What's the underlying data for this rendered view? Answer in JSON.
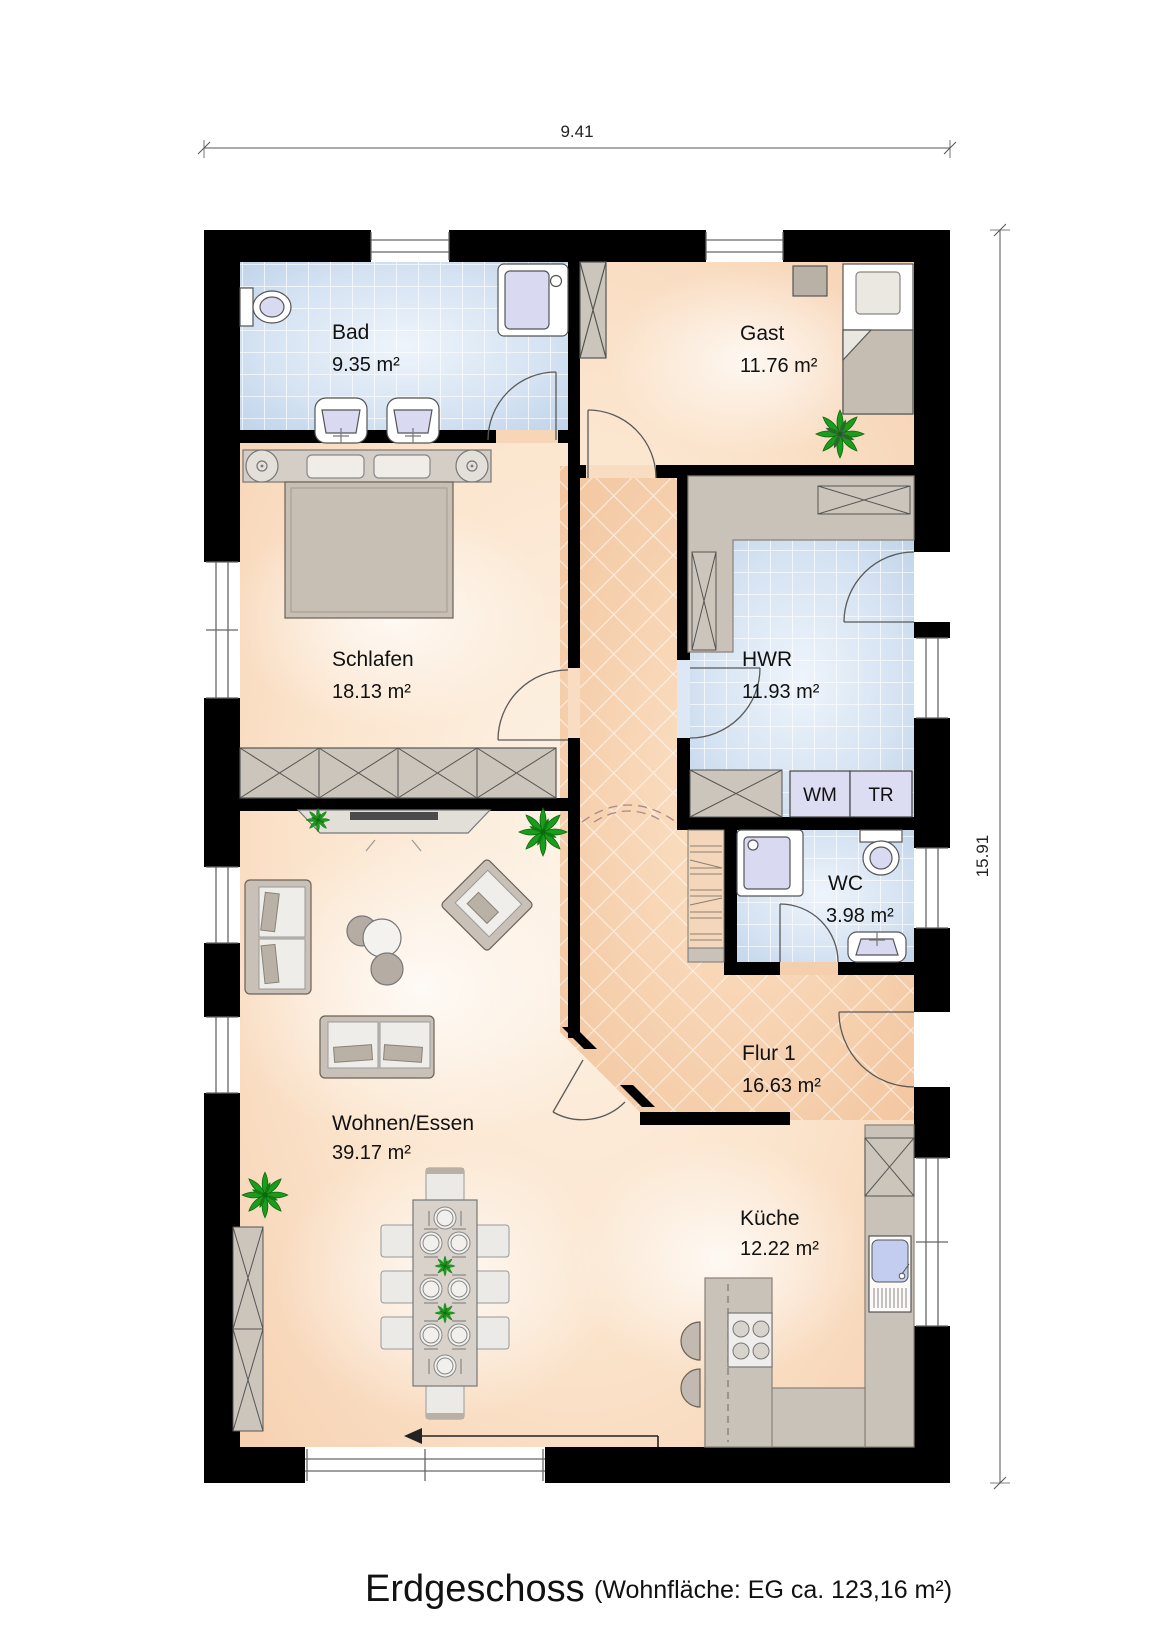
{
  "dimensions": {
    "width_label": "9.41",
    "height_label": "15.91"
  },
  "rooms": [
    {
      "name": "Bad",
      "area": "9.35 m²"
    },
    {
      "name": "Gast",
      "area": "11.76 m²"
    },
    {
      "name": "Schlafen",
      "area": "18.13 m²"
    },
    {
      "name": "HWR",
      "area": "11.93 m²"
    },
    {
      "name": "WC",
      "area": "3.98 m²"
    },
    {
      "name": "Flur 1",
      "area": "16.63 m²"
    },
    {
      "name": "Wohnen/Essen",
      "area": "39.17 m²"
    },
    {
      "name": "Küche",
      "area": "12.22 m²"
    }
  ],
  "appliances": {
    "washing_machine": "WM",
    "dryer": "TR"
  },
  "footer": {
    "floor_title": "Erdgeschoss",
    "area_note": "(Wohnfläche: EG  ca. 123,16 m²)"
  },
  "colors": {
    "wall": "#000000",
    "floor_peach": "#f8d7ba",
    "floor_tile_blue": "#c8daee",
    "hall_peach": "#f5c9a4",
    "furniture_gray": "#c9c2b8",
    "fixture_lavender": "#d9d9f2",
    "plant_green": "#1c9b1c"
  }
}
